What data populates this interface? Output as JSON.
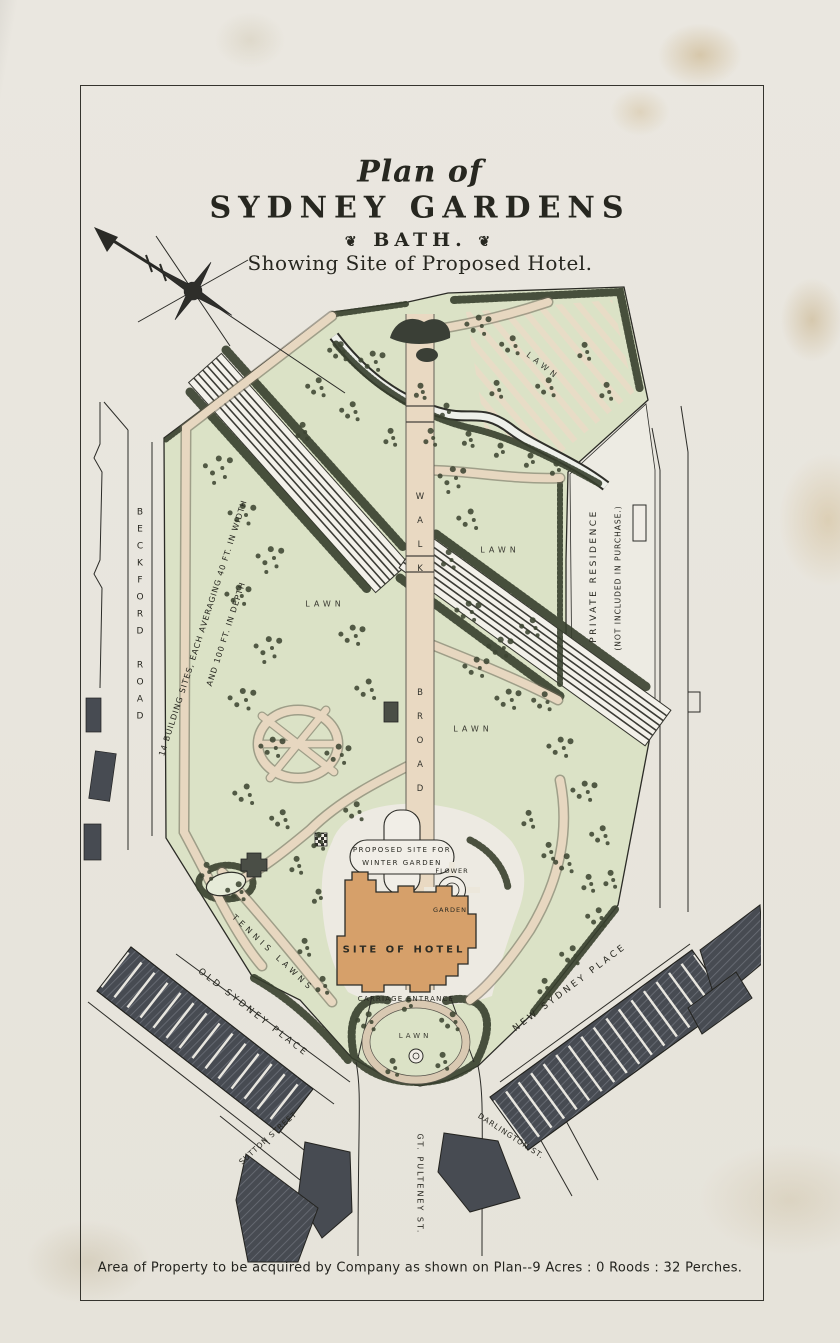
{
  "document": {
    "title": {
      "line1": "Plan of",
      "line2": "SYDNEY GARDENS",
      "line3": "BATH.",
      "ornament_left": "❦",
      "ornament_right": "❦",
      "line4": "Showing Site of Proposed Hotel."
    },
    "footer_caption": "Area of Property to be acquired by Company as shown on Plan--9 Acres : 0 Roods : 32 Perches."
  },
  "map": {
    "roads": {
      "beckford": "BECKFORD ROAD",
      "old_sydney": "OLD SYDNEY PLACE",
      "new_sydney": "NEW SYDNEY PLACE",
      "sutton": "SUTTON STREET",
      "pulteney": "GT. PULTENEY ST.",
      "darlington": "DARLINGTON ST."
    },
    "features": {
      "building_sites_line1": "14 BUILDING SITES, EACH AVERAGING 40 FT. IN WIDTH",
      "building_sites_line2": "AND 100 FT. IN DEPTH",
      "broad_walk_word1": "BROAD",
      "broad_walk_word2": "WALK",
      "private_residence_line1": "PRIVATE RESIDENCE",
      "private_residence_line2": "(NOT INCLUDED IN PURCHASE.)",
      "winter_garden_line1": "PROPOSED SITE FOR",
      "winter_garden_line2": "WINTER GARDEN",
      "flower": "FLOWER",
      "garden": "GARDEN",
      "hotel": "SITE OF HOTEL",
      "carriage": "CARRIAGE ENTRANCE",
      "tennis": "TENNIS LAWNS"
    },
    "lawn_labels": {
      "upper_right": "LAWN",
      "mid_left": "LAWN",
      "mid_right": "LAWN",
      "lower_right": "LAWN",
      "entrance": "LAWN"
    },
    "colors": {
      "paper": "#e9e6df",
      "lawn_green": "#dbe2c6",
      "path_tan": "#e7d7c0",
      "hotel_tan": "#d6a06a",
      "ink": "#2b2b26",
      "tree": "#3e4632",
      "house_dark": "#474b52",
      "stain": "#c9b289"
    }
  }
}
